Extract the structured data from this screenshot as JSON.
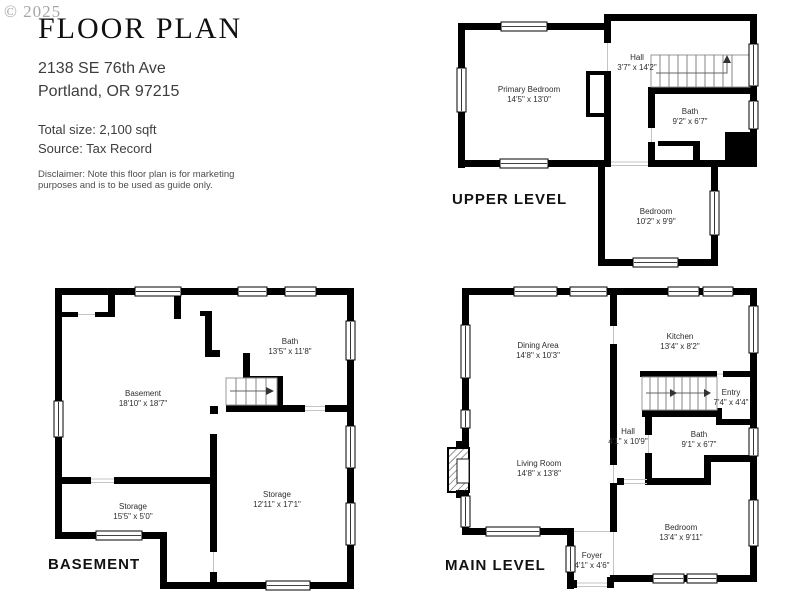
{
  "watermark": "© 2025",
  "header": {
    "title": "FLOOR PLAN",
    "address_line1": "2138 SE 76th Ave",
    "address_line2": "Portland, OR 97215",
    "total_size": "Total size: 2,100 sqft",
    "source": "Source: Tax Record",
    "disclaimer_line1": "Disclaimer: Note this floor plan is for marketing",
    "disclaimer_line2": "purposes and is to be used as guide only."
  },
  "levels": {
    "upper": {
      "label": "UPPER LEVEL",
      "rooms": {
        "primary_bedroom": {
          "name": "Primary Bedroom",
          "dims": "14'5\" x 13'0\""
        },
        "hall": {
          "name": "Hall",
          "dims": "3'7\" x 14'2\""
        },
        "bath": {
          "name": "Bath",
          "dims": "9'2\" x 6'7\""
        },
        "bedroom": {
          "name": "Bedroom",
          "dims": "10'2\" x 9'9\""
        }
      }
    },
    "basement": {
      "label": "BASEMENT",
      "rooms": {
        "bath": {
          "name": "Bath",
          "dims": "13'5\" x 11'8\""
        },
        "basement": {
          "name": "Basement",
          "dims": "18'10\" x 18'7\""
        },
        "storage_small": {
          "name": "Storage",
          "dims": "15'5\" x 5'0\""
        },
        "storage_large": {
          "name": "Storage",
          "dims": "12'11\" x 17'1\""
        }
      }
    },
    "main": {
      "label": "MAIN LEVEL",
      "rooms": {
        "dining": {
          "name": "Dining Area",
          "dims": "14'8\" x 10'3\""
        },
        "kitchen": {
          "name": "Kitchen",
          "dims": "13'4\" x 8'2\""
        },
        "entry": {
          "name": "Entry",
          "dims": "7'4\" x 4'4\""
        },
        "hall": {
          "name": "Hall",
          "dims": "4'1\" x 10'9\""
        },
        "bath": {
          "name": "Bath",
          "dims": "9'1\" x 6'7\""
        },
        "living": {
          "name": "Living Room",
          "dims": "14'8\" x 13'8\""
        },
        "bedroom": {
          "name": "Bedroom",
          "dims": "13'4\" x 9'11\""
        },
        "foyer": {
          "name": "Foyer",
          "dims": "4'1\" x 4'6\""
        }
      }
    }
  },
  "colors": {
    "wall": "#000000",
    "watermark": "#a6a6a6",
    "text": "#2d2d2d"
  }
}
